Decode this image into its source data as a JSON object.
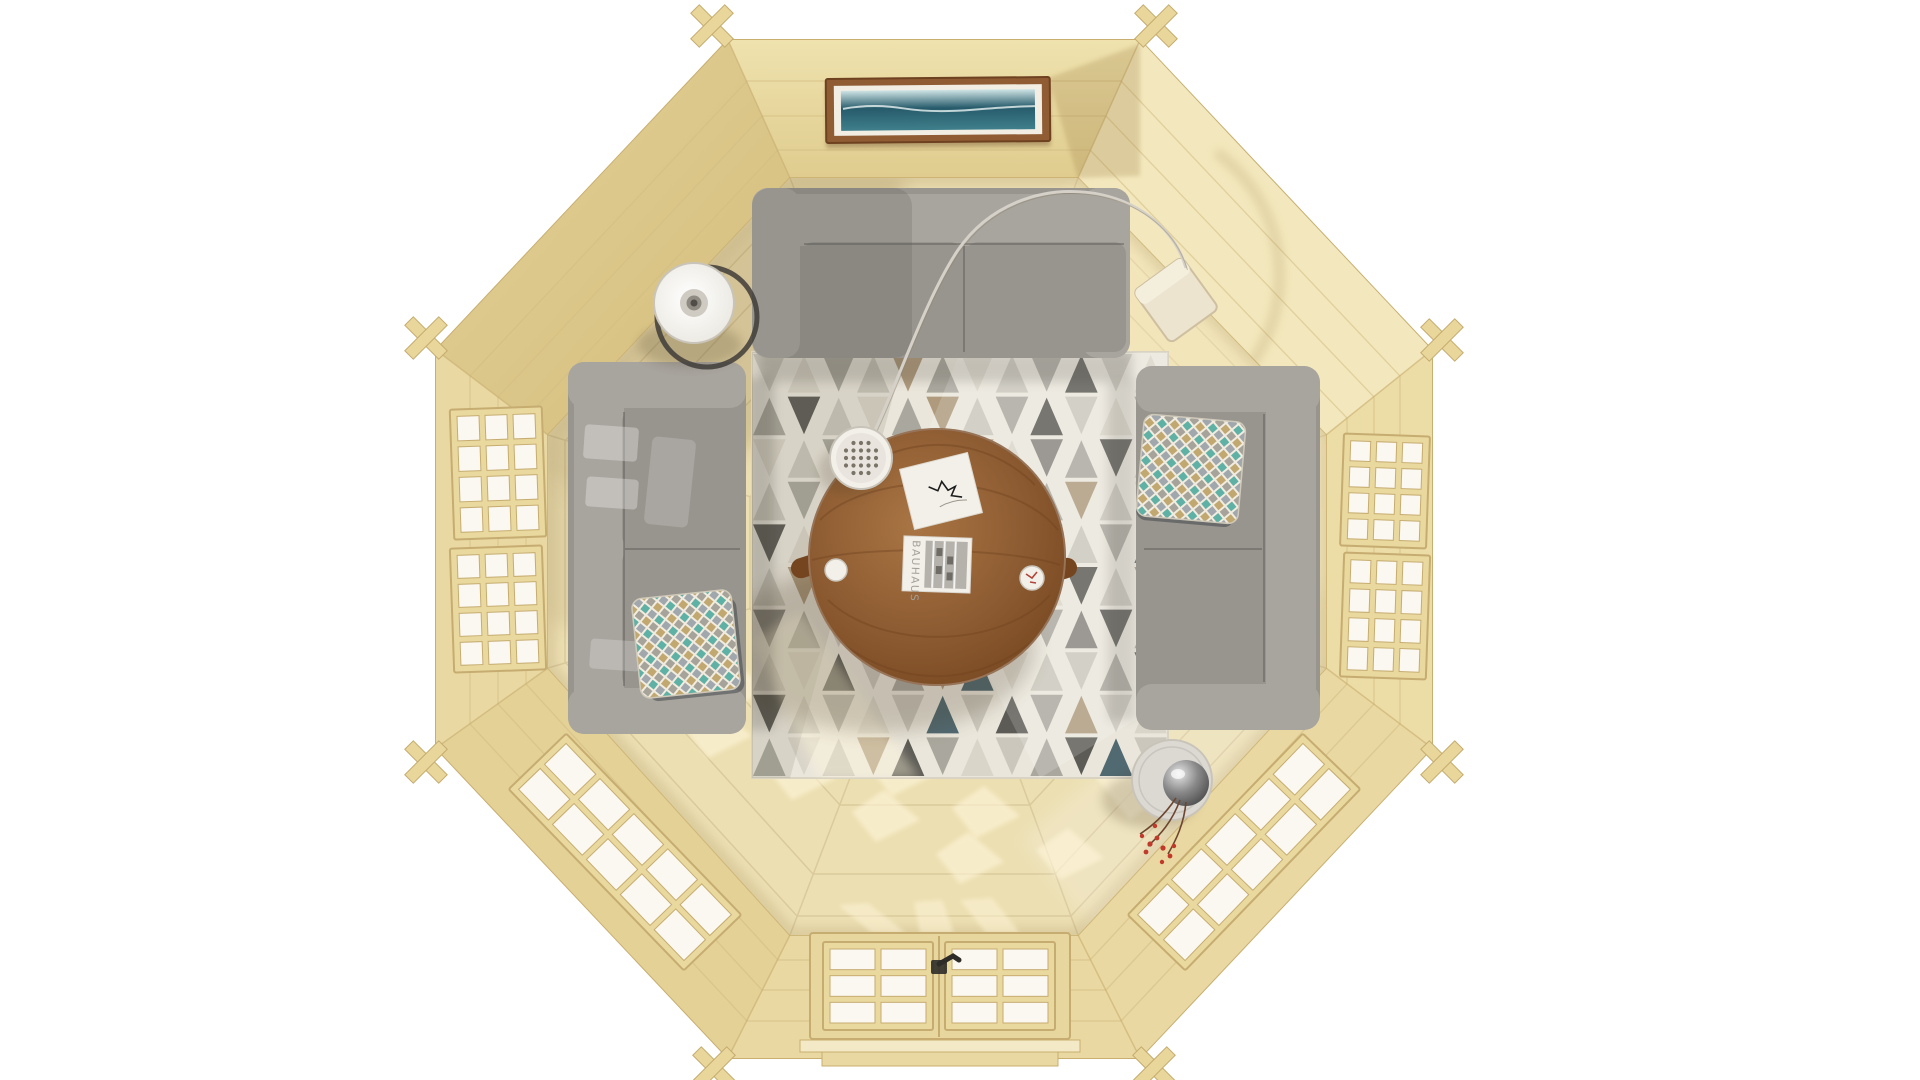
{
  "scene": {
    "description": "Top-down 3D render of an octagonal wooden cabin interior: three grey sofas around a round wooden coffee table on a triangle-pattern rug, seascape painting on the top wall, glazed double door at the bottom, lattice windows on five walls, arc floor lamp and cone lamp.",
    "background": "#ffffff"
  },
  "book": {
    "title": "BAUHAUS"
  },
  "palette": {
    "bg": "#ffffff",
    "wall-base": "#e7d6a0",
    "wall-top-a": "#efe2ae",
    "wall-top-b": "#dfcc8e",
    "wall-bright": "#f3e8bd",
    "wall-mid": "#ecdca6",
    "wall-soft": "#e9d8a2",
    "wall-tl-a": "#e4d196",
    "wall-tl-b": "#d3bd7d",
    "wall-edge": "#c8ae6f",
    "wall-line": "#d3be84",
    "notch": "#e8d69b",
    "notch-edge": "#c5ab6e",
    "floor": "#ecdfb2",
    "floor-light": "#f4e9c6",
    "floor-line": "#ccb98a",
    "shadow": "#6b5530",
    "sun": "#fff6da",
    "win-frame": "#e9d99f",
    "win-frame-edge": "#c6ac70",
    "glass": "#fbf8f1",
    "door-wood": "#e7d69d",
    "handle": "#2e2c29",
    "frame-wood": "#8f5c34",
    "frame-wood-dark": "#6e4120",
    "mat": "#f2eee4",
    "sea-dark": "#275b6b",
    "sea": "#3f7f8b",
    "sky": "#cfe4e5",
    "rug-base": "#eae6db",
    "sofa": "#98948e",
    "sofa-light": "#a8a49e",
    "sofa-dark": "#7b7872",
    "sofa-crevice": "#5c5a55",
    "pillow-base": "#f1ecdf",
    "pillow-teal": "#45a79c",
    "pillow-tan": "#b99c5e",
    "pillow-gray": "#7e8b99",
    "table-wood": "#8e5c32",
    "table-wood-dark": "#74451f",
    "table-wood-light": "#a97544",
    "white-obj": "#f3f0ea",
    "obj-edge": "#c9c4ba",
    "metal-ring": "#3f3c38",
    "lamp-inner": "#8f8a82",
    "wire": "#d5d1c9",
    "dot": "#7a7468",
    "side-table": "#dcd9d3",
    "sphere-dark": "#3a3a3a",
    "sphere-mid": "#8a8a8a",
    "sphere-light": "#e6e6e6",
    "berry": "#c0392b",
    "branch": "#6e4630",
    "photo": "#b5b2ac"
  },
  "rug": {
    "x": 752,
    "y": 352,
    "w": 416,
    "h": 426,
    "cols": 12,
    "rows": 10,
    "palette": [
      "#e9e5da",
      "#c9c5ba",
      "#a7a49b",
      "#83807a",
      "#54534e",
      "#ac9678",
      "#49626c",
      "#d9d4c8"
    ],
    "matrix": [
      "172152712417",
      "241725124172",
      "712341573241",
      "125172412517",
      "471215741126",
      "152471127415",
      "321743512342",
      "174125671124",
      "412716142517",
      "271542712461"
    ]
  },
  "windows": [
    {
      "name": "left-wall-window-upper",
      "cx": 498,
      "cy": 473,
      "w": 92,
      "h": 130,
      "rot": -2,
      "cols": 3,
      "rows": 4
    },
    {
      "name": "left-wall-window-lower",
      "cx": 498,
      "cy": 609,
      "w": 92,
      "h": 124,
      "rot": -2,
      "cols": 3,
      "rows": 4
    },
    {
      "name": "right-wall-window-upper",
      "cx": 1385,
      "cy": 491,
      "w": 86,
      "h": 112,
      "rot": 2,
      "cols": 3,
      "rows": 4
    },
    {
      "name": "right-wall-window-lower",
      "cx": 1385,
      "cy": 616,
      "w": 86,
      "h": 124,
      "rot": 2,
      "cols": 3,
      "rows": 4
    },
    {
      "name": "bottom-left-window",
      "cx": 625,
      "cy": 852,
      "w": 252,
      "h": 80,
      "rot": 46,
      "cols": 5,
      "rows": 2
    },
    {
      "name": "bottom-right-window",
      "cx": 1244,
      "cy": 852,
      "w": 252,
      "h": 80,
      "rot": -46,
      "cols": 5,
      "rows": 2
    },
    {
      "name": "door-left-panes",
      "cx": 878,
      "cy": 986,
      "w": 110,
      "h": 88,
      "rot": 0,
      "cols": 2,
      "rows": 3
    },
    {
      "name": "door-right-panes",
      "cx": 1000,
      "cy": 986,
      "w": 110,
      "h": 88,
      "rot": 0,
      "cols": 2,
      "rows": 3
    }
  ],
  "lampDots": {
    "cx": 861,
    "cy": 458,
    "r": 21,
    "spacing": 7.5,
    "dotR": 2.1
  }
}
